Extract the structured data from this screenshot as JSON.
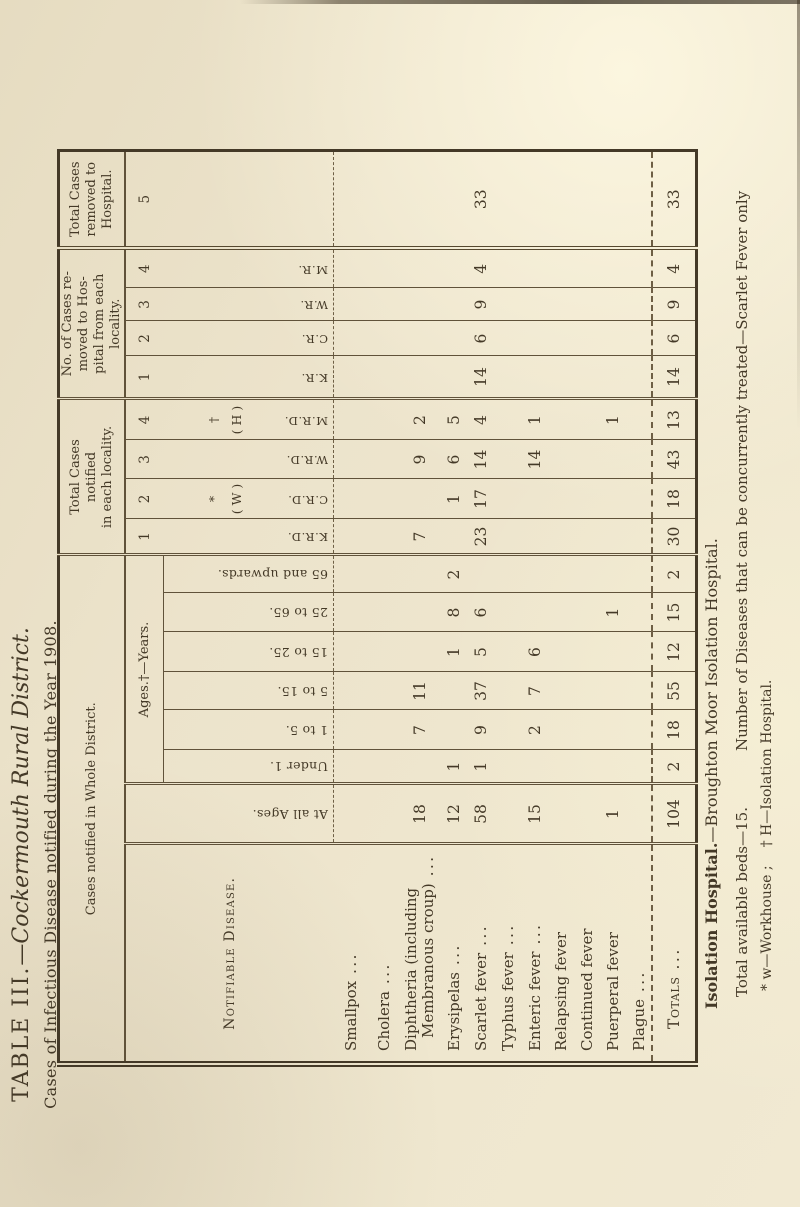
{
  "title": {
    "table_no": "TABLE III.",
    "district": "—Cockermouth Rural District.",
    "subtitle": "Cases of Infectious Disease notified during the Year 1908."
  },
  "table": {
    "header": {
      "whole_district": "Cases notified in Whole District.",
      "notified_locality_lines": [
        "Total Cases",
        "notified",
        "in each locality."
      ],
      "removed_locality_lines": [
        "No. of Cases re-",
        "moved to Hos-",
        "pital from each",
        "locality."
      ],
      "total_removed_lines": [
        "Total Cases",
        "removed to",
        "Hospital."
      ],
      "notifiable_disease": "Notifiable Disease.",
      "at_all_ages": "At all Ages.",
      "ages_years": "Ages.†—Years.",
      "age_labels": [
        "Under 1.",
        "1 to 5.",
        "5 to 15.",
        "15 to 25.",
        "25 to 65.",
        "65 and upwards."
      ],
      "notified_numbers": [
        "1",
        "2",
        "3",
        "4"
      ],
      "removed_numbers": [
        "1",
        "2",
        "3",
        "4"
      ],
      "total_removed_number": "5",
      "workhouse_mark": [
        "*",
        "( W )"
      ],
      "hospital_mark": [
        "†",
        "( H )"
      ],
      "notified_initials": [
        "K.R.D.",
        "C.R.D.",
        "W.R.D.",
        "M.R.D."
      ],
      "removed_initials": [
        "K.R.",
        "C.R.",
        "W.R.",
        "M.R."
      ]
    },
    "rows": [
      {
        "name": "Smallpox",
        "dots": "...",
        "values": [
          "",
          "",
          "",
          "",
          "",
          "",
          "",
          "",
          "",
          "",
          "",
          "",
          "",
          "",
          "",
          ""
        ]
      },
      {
        "name": "Cholera",
        "dots": "...",
        "values": [
          "",
          "",
          "",
          "",
          "",
          "",
          "",
          "",
          "",
          "",
          "",
          "",
          "",
          "",
          "",
          ""
        ]
      },
      {
        "name": "Diphtheria (including",
        "name2": "Membranous croup)",
        "dots": "...",
        "values": [
          "18",
          "",
          "7",
          "11",
          "",
          "",
          "",
          "7",
          "",
          "9",
          "2",
          "",
          "",
          "",
          "",
          ""
        ]
      },
      {
        "name": "Erysipelas",
        "dots": "...",
        "values": [
          "12",
          "1",
          "",
          "",
          "1",
          "8",
          "2",
          "",
          "1",
          "6",
          "5",
          "",
          "",
          "",
          "",
          ""
        ]
      },
      {
        "name": "Scarlet fever",
        "dots": "...",
        "values": [
          "58",
          "1",
          "9",
          "37",
          "5",
          "6",
          "",
          "23",
          "17",
          "14",
          "4",
          "14",
          "6",
          "9",
          "4",
          "33"
        ]
      },
      {
        "name": "Typhus fever",
        "dots": "...",
        "values": [
          "",
          "",
          "",
          "",
          "",
          "",
          "",
          "",
          "",
          "",
          "",
          "",
          "",
          "",
          "",
          ""
        ]
      },
      {
        "name": "Enteric fever",
        "dots": "...",
        "values": [
          "15",
          "",
          "2",
          "7",
          "6",
          "",
          "",
          "",
          "",
          "14",
          "1",
          "",
          "",
          "",
          "",
          ""
        ]
      },
      {
        "name": "Relapsing fever",
        "dots": "",
        "values": [
          "",
          "",
          "",
          "",
          "",
          "",
          "",
          "",
          "",
          "",
          "",
          "",
          "",
          "",
          "",
          ""
        ]
      },
      {
        "name": "Continued fever",
        "dots": "",
        "values": [
          "",
          "",
          "",
          "",
          "",
          "",
          "",
          "",
          "",
          "",
          "",
          "",
          "",
          "",
          "",
          ""
        ]
      },
      {
        "name": "Puerperal fever",
        "dots": "",
        "values": [
          "1",
          "",
          "",
          "",
          "",
          "1",
          "",
          "",
          "",
          "",
          "1",
          "",
          "",
          "",
          "",
          ""
        ]
      },
      {
        "name": "Plague",
        "dots": "...",
        "values": [
          "",
          "",
          "",
          "",
          "",
          "",
          "",
          "",
          "",
          "",
          "",
          "",
          "",
          "",
          "",
          ""
        ]
      },
      {
        "name": "Totals",
        "dots": "...",
        "is_total": true,
        "values": [
          "104",
          "2",
          "18",
          "55",
          "12",
          "15",
          "2",
          "30",
          "18",
          "43",
          "13",
          "14",
          "6",
          "9",
          "4",
          "33"
        ]
      }
    ]
  },
  "footnotes": {
    "line1_label": "Isolation Hospital.",
    "line1_rest": "—Broughton Moor Isolation Hospital.",
    "line2_left": "Total available beds—15.",
    "line2_right": "Number of Diseases that can be concurrently treated—Scarlet Fever only",
    "line3_left": "* w—Workhouse ;",
    "line3_right": "† H—Isolation Hospital."
  }
}
